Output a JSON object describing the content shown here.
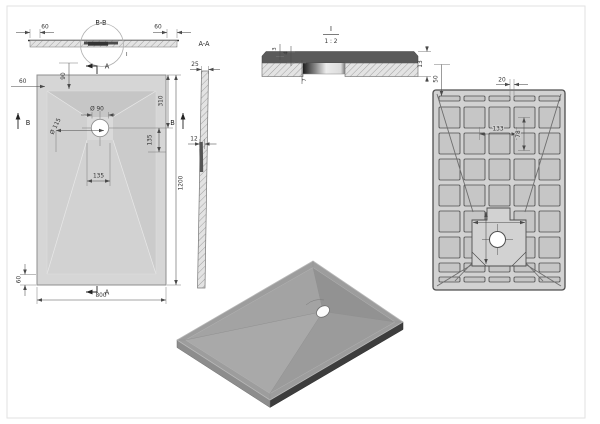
{
  "meta": {
    "drawing_type": "shower-tray technical drawing, multi-view",
    "tray_fill_color": "#d6d6d6",
    "line_color": "#4a4a4a",
    "iso_top_color": "#9d9d9d",
    "iso_edge_color": "#3d3d3d"
  },
  "section_bb": {
    "title": "B-B",
    "detail_label": "I",
    "dim_rim_left": "60",
    "dim_rim_right": "60"
  },
  "front_view": {
    "cut_a_top": "A",
    "cut_a_bottom": "A",
    "cut_b_left": "B",
    "cut_b_right": "B",
    "dim_rim_left": "60",
    "dim_rim_top": "90",
    "dim_rim_bottom": "60",
    "dim_drain_hole": "Ø 90",
    "dim_drain_flange": "Ø 115",
    "dim_drain_from_top": "310",
    "dim_recess_below_center": "135",
    "dim_drain_offset": "135",
    "dim_width": "800",
    "dim_height": "1200"
  },
  "section_aa": {
    "title": "A-A",
    "dim_edge_thickness": "25",
    "dim_mid_thickness": "12"
  },
  "detail": {
    "title": "I",
    "scale": "1 : 2",
    "dim_top_layer": "3",
    "dim_band": "4",
    "dim_recess_depth": "7",
    "dim_total_height": "13"
  },
  "bottom_view": {
    "dim_rim": "50",
    "dim_rib_gap": "20",
    "dim_rib_pitch": "133",
    "dim_rib_width": "78",
    "dim_recess_width": "315",
    "dim_recess_height": "340"
  }
}
